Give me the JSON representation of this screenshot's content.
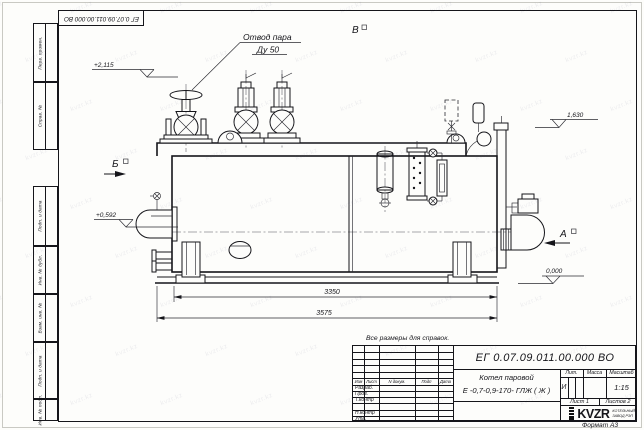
{
  "frame": {
    "designation_top": "ЕГ 0.07.09.011.00.000 ВО",
    "format_label": "Формат А3",
    "side_columns": [
      "Перв. примен.",
      "Справ. №",
      "Подп. и дата",
      "Инв. № дубл.",
      "Взам. инв. №",
      "Подп. и дата",
      "Инв. № подл."
    ]
  },
  "annotations": {
    "note": "Все размеры для справок.",
    "steam_outlet_line1": "Отвод пара",
    "steam_outlet_line2": "Ду 50",
    "view_top": "В",
    "view_left": "Б",
    "view_right": "А",
    "elev_top_left": "+2,115",
    "elev_mid_left": "+0,592",
    "elev_top_right": "1,630",
    "elev_base": "0,000",
    "dim_shell_length": "3350",
    "dim_overall_length": "3575"
  },
  "title_block": {
    "designation": "ЕГ 0.07.09.011.00.000  ВО",
    "product_name_line1": "Котел паровой",
    "product_name_line2": "Е -0,7-0,9-170- ГЛЖ ( Ж )",
    "col_izm": "Изм",
    "col_list": "Лист",
    "col_ndoc": "N докум.",
    "col_podp": "Подп",
    "col_data": "Дата",
    "rows": [
      "Разраб.",
      "Пров.",
      "Т.контр",
      "",
      "Н.контр",
      "Утв."
    ],
    "lit_header": "Лит.",
    "massa_header": "Масса",
    "masshtab_header": "Масштаб",
    "lit_value": "И",
    "masshtab_value": "1:15",
    "sheet_label": "Лист 1",
    "sheets_label": "Листов  2",
    "logo_text": "KVZR",
    "company_line1": "КОТЕЛЬНЫЙ",
    "company_line2": "ЗАВОД РЭП"
  },
  "watermark": {
    "text": "kvzr.kz"
  }
}
